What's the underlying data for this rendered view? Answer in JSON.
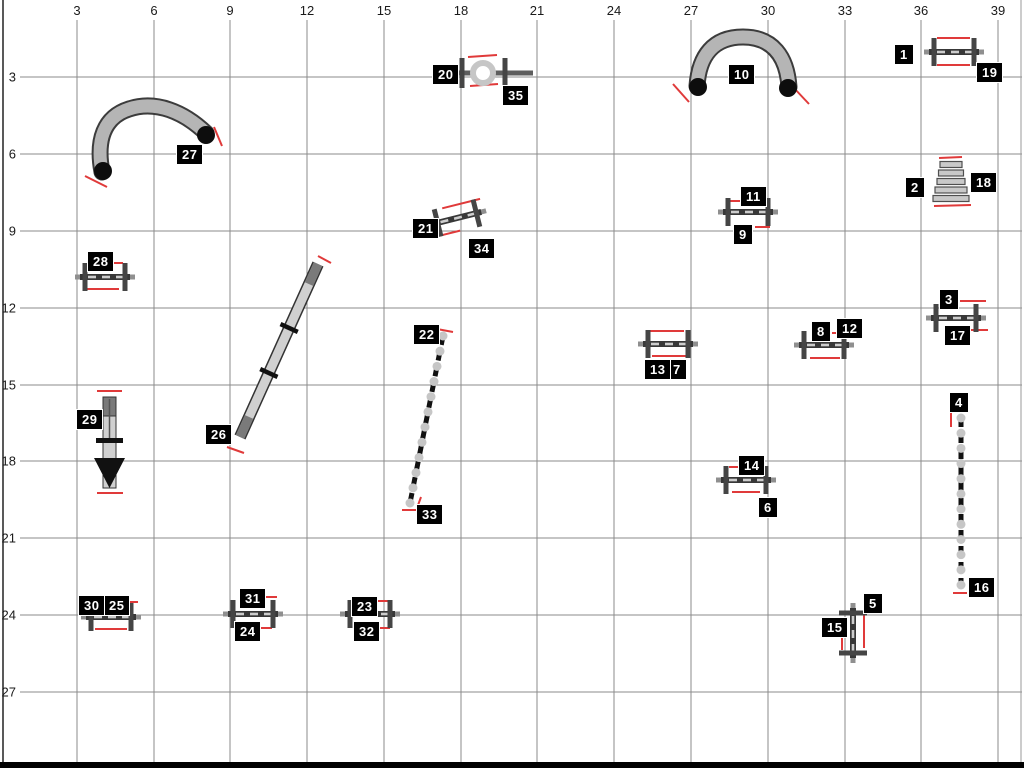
{
  "meta": {
    "description": "Dog agility course map on numbered grid"
  },
  "canvas": {
    "w": 1024,
    "h": 768,
    "bg": "#ffffff"
  },
  "palette": {
    "grid": "#8b8b8b",
    "border": "#000000",
    "red": "#e03a3a",
    "bar_outer": "#8f8f8f",
    "bar_dark": "#383838",
    "bar_dash": "#cdcdcd",
    "wing": "#454545",
    "tunnel_fill": "#b5b5b5",
    "tunnel_edge": "#3c3c3c",
    "cap": "#0d0d0d",
    "plank_fill": "#d0d0d0",
    "plank_edge": "#333333",
    "contact": "#7a7a7a",
    "pole": "#c6c6c6",
    "label_bg": "#000000",
    "label_fg": "#ffffff"
  },
  "axis": {
    "top_ticks": [
      "3",
      "6",
      "9",
      "12",
      "15",
      "18",
      "21",
      "24",
      "27",
      "30",
      "33",
      "36",
      "39"
    ],
    "top_xs": [
      77,
      154,
      230,
      307,
      384,
      461,
      537,
      614,
      691,
      768,
      845,
      921,
      998
    ],
    "top_y": 4,
    "left_ticks": [
      "3",
      "6",
      "9",
      "12",
      "15",
      "18",
      "21",
      "24",
      "27"
    ],
    "left_ys": [
      77,
      154,
      231,
      308,
      385,
      461,
      538,
      615,
      692
    ],
    "left_x": 0
  },
  "grid": {
    "v_xs": [
      77,
      154,
      230,
      307,
      384,
      461,
      537,
      614,
      691,
      768,
      845,
      921,
      998
    ],
    "v_top": 20,
    "v_bottom": 762,
    "h_ys": [
      77,
      154,
      231,
      308,
      385,
      461,
      538,
      615,
      692
    ],
    "h_left": 20,
    "h_right": 1022,
    "left_border_x": 3,
    "right_border_x": 1021,
    "bottom_bar_y": 762,
    "bottom_bar_h": 6
  },
  "labels": [
    {
      "n": "1",
      "x": 894,
      "y": 44
    },
    {
      "n": "2",
      "x": 905,
      "y": 177
    },
    {
      "n": "3",
      "x": 939,
      "y": 289
    },
    {
      "n": "4",
      "x": 949,
      "y": 392
    },
    {
      "n": "5",
      "x": 863,
      "y": 593
    },
    {
      "n": "6",
      "x": 758,
      "y": 497
    },
    {
      "n": "7",
      "x": 667,
      "y": 359
    },
    {
      "n": "8",
      "x": 811,
      "y": 321
    },
    {
      "n": "9",
      "x": 733,
      "y": 224
    },
    {
      "n": "10",
      "x": 728,
      "y": 64
    },
    {
      "n": "11",
      "x": 740,
      "y": 186
    },
    {
      "n": "12",
      "x": 836,
      "y": 318
    },
    {
      "n": "13",
      "x": 644,
      "y": 359
    },
    {
      "n": "14",
      "x": 738,
      "y": 455
    },
    {
      "n": "15",
      "x": 821,
      "y": 617
    },
    {
      "n": "16",
      "x": 968,
      "y": 577
    },
    {
      "n": "17",
      "x": 944,
      "y": 325
    },
    {
      "n": "18",
      "x": 970,
      "y": 172
    },
    {
      "n": "19",
      "x": 976,
      "y": 62
    },
    {
      "n": "20",
      "x": 432,
      "y": 64
    },
    {
      "n": "21",
      "x": 412,
      "y": 218
    },
    {
      "n": "22",
      "x": 413,
      "y": 324
    },
    {
      "n": "23",
      "x": 351,
      "y": 596
    },
    {
      "n": "24",
      "x": 234,
      "y": 621
    },
    {
      "n": "25",
      "x": 103,
      "y": 595
    },
    {
      "n": "26",
      "x": 205,
      "y": 424
    },
    {
      "n": "27",
      "x": 176,
      "y": 144
    },
    {
      "n": "28",
      "x": 87,
      "y": 251
    },
    {
      "n": "29",
      "x": 76,
      "y": 409
    },
    {
      "n": "30",
      "x": 78,
      "y": 595
    },
    {
      "n": "31",
      "x": 239,
      "y": 588
    },
    {
      "n": "32",
      "x": 353,
      "y": 621
    },
    {
      "n": "33",
      "x": 416,
      "y": 504
    },
    {
      "n": "34",
      "x": 468,
      "y": 238
    },
    {
      "n": "35",
      "x": 502,
      "y": 85
    }
  ],
  "jumps": [
    {
      "id": "1-19",
      "cx": 954,
      "cy": 52,
      "angle": 0,
      "reds": [
        [
          -17,
          -14,
          16,
          -14
        ],
        [
          -17,
          13,
          16,
          13
        ]
      ]
    },
    {
      "id": "3-17",
      "cx": 956,
      "cy": 318,
      "angle": 0,
      "reds": [
        [
          4,
          -17,
          30,
          -17
        ],
        [
          10,
          12,
          32,
          12
        ]
      ]
    },
    {
      "id": "8-12",
      "cx": 824,
      "cy": 345,
      "angle": 0,
      "reds": [
        [
          -14,
          13,
          16,
          13
        ],
        [
          8,
          -12,
          14,
          -12
        ]
      ]
    },
    {
      "id": "11-9",
      "cx": 748,
      "cy": 212,
      "angle": 0,
      "reds": [
        [
          -21,
          -11,
          -5,
          -11
        ],
        [
          7,
          15,
          22,
          15
        ]
      ]
    },
    {
      "id": "13-7",
      "cx": 668,
      "cy": 344,
      "angle": 0,
      "reds": [
        [
          -18,
          -13,
          16,
          -13
        ],
        [
          -16,
          12,
          18,
          12
        ]
      ]
    },
    {
      "id": "14-6",
      "cx": 746,
      "cy": 480,
      "angle": 0,
      "reds": [
        [
          -17,
          -13,
          -8,
          -13
        ],
        [
          -14,
          12,
          14,
          12
        ]
      ]
    },
    {
      "id": "15-5",
      "cx": 853,
      "cy": 633,
      "angle": 90,
      "reds": [
        [
          -14,
          11,
          17,
          11
        ],
        [
          -21,
          -11,
          15,
          -11
        ]
      ]
    },
    {
      "id": "21-34",
      "cx": 457,
      "cy": 218,
      "angle": -14,
      "reds": [
        [
          -12,
          -13,
          27,
          -13
        ],
        [
          -21,
          13,
          0,
          13
        ]
      ]
    },
    {
      "id": "28",
      "cx": 105,
      "cy": 277,
      "angle": 0,
      "reds": [
        [
          -18,
          12,
          14,
          12
        ],
        [
          7,
          -14,
          18,
          -14
        ]
      ]
    },
    {
      "id": "30-25",
      "cx": 111,
      "cy": 617,
      "angle": 0,
      "reds": [
        [
          -16,
          12,
          16,
          12
        ],
        [
          16,
          -15,
          27,
          -15
        ]
      ]
    },
    {
      "id": "31-24",
      "cx": 253,
      "cy": 614,
      "angle": 0,
      "reds": [
        [
          11,
          -17,
          24,
          -17
        ],
        [
          6,
          14,
          19,
          14
        ]
      ]
    },
    {
      "id": "23-32",
      "cx": 370,
      "cy": 614,
      "angle": 0,
      "reds": [
        [
          5,
          -13,
          19,
          -13
        ],
        [
          7,
          14,
          20,
          14
        ]
      ]
    }
  ],
  "tire": {
    "id": "20-35",
    "cx": 483,
    "cy": 73,
    "rail_x1": 455,
    "rail_x2": 533,
    "post_xs": [
      462,
      505
    ],
    "post_h": 30,
    "ring_r": 10,
    "reds": [
      [
        468,
        57,
        497,
        55
      ],
      [
        470,
        86,
        498,
        84
      ]
    ]
  },
  "tunnels": [
    {
      "id": "27",
      "path": "M102,172 C96,140 104,117 129,109 C156,100 184,112 206,133",
      "caps": [
        [
          103,
          171
        ],
        [
          206,
          135
        ]
      ],
      "reds": [
        [
          85,
          176,
          107,
          187
        ],
        [
          214,
          127,
          222,
          146
        ]
      ]
    },
    {
      "id": "10",
      "path": "M697,86 C699,56 713,37 743,37 C773,37 787,57 789,87",
      "caps": [
        [
          698,
          87
        ],
        [
          788,
          88
        ]
      ],
      "reds": [
        [
          673,
          84,
          689,
          102
        ],
        [
          793,
          87,
          809,
          104
        ]
      ]
    }
  ],
  "weaves": [
    {
      "id": "22-33",
      "x1": 443,
      "y1": 336,
      "x2": 410,
      "y2": 503,
      "poles": 12,
      "reds": [
        [
          437,
          329,
          453,
          332
        ],
        [
          421,
          497,
          417,
          508
        ],
        [
          402,
          510,
          417,
          510
        ]
      ]
    },
    {
      "id": "4-16",
      "x1": 961,
      "y1": 418,
      "x2": 961,
      "y2": 585,
      "poles": 12,
      "reds": [
        [
          951,
          412,
          951,
          427
        ],
        [
          951,
          412,
          968,
          412
        ],
        [
          953,
          593,
          967,
          593
        ]
      ]
    }
  ],
  "dogwalk": {
    "id": "26",
    "x1": 240,
    "y1": 437,
    "x2": 318,
    "y2": 264,
    "width": 9,
    "contact_len": 22,
    "bars_t": [
      0.37,
      0.63
    ],
    "reds": [
      [
        227,
        447,
        244,
        453
      ],
      [
        318,
        256,
        331,
        263
      ]
    ]
  },
  "teeter": {
    "id": "29",
    "cx": 109.5,
    "top": 397,
    "bottom": 488,
    "plank_w": 13,
    "dark_top_h": 19,
    "pivot_y": 438,
    "arrow_base_y": 458,
    "arrow_half_w": 15.5,
    "reds": [
      [
        97,
        391,
        122,
        391
      ],
      [
        97,
        493,
        123,
        493
      ]
    ]
  },
  "longjump": {
    "id": "2-18",
    "cx": 951,
    "plank_tops": [
      161.5,
      170,
      178.5,
      187,
      195.5
    ],
    "plank_widths": [
      22,
      25,
      28,
      32,
      36
    ],
    "plank_h": 6,
    "reds": [
      [
        939,
        158,
        962,
        157
      ],
      [
        934,
        206,
        971,
        205
      ]
    ]
  }
}
